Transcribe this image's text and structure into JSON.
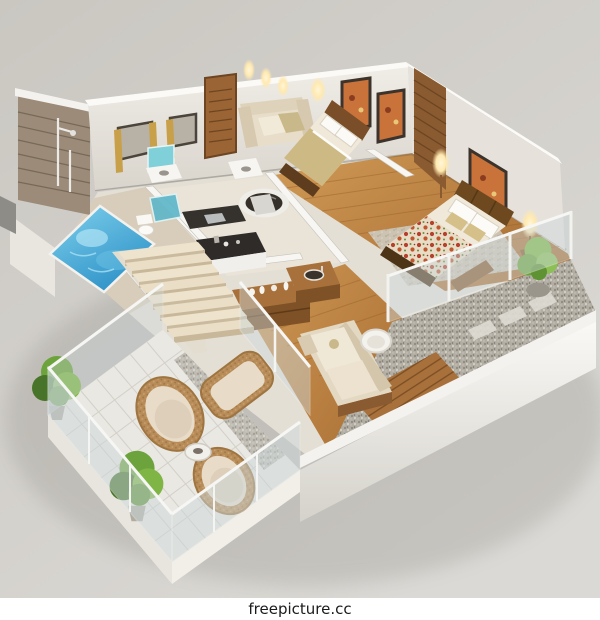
{
  "watermark": {
    "text": "freepicture.cc"
  },
  "colors": {
    "background_top": "#cac7c1",
    "background_bottom": "#dbd9d5",
    "watermark_bar": "#ffffff",
    "watermark_text": "#1b1b1b",
    "slab_white": "#f7f6f3",
    "slab_shade": "#d5d2cb",
    "wall_face": "#e6e2db",
    "wall_top": "#fbfaf7",
    "brick_wall": "#9c8b79",
    "pool_deep": "#2f93c8",
    "pool_light": "#7fd0ec",
    "pool_deck": "#d8cdbb",
    "tile_floor": "#e9e3d8",
    "wood_floor": "#c08544",
    "wood_dark": "#8a5a30",
    "door_wood": "#9a6434",
    "plant_green": "#6da33c",
    "plant_dark": "#48742a",
    "glass_tint": "#cdd9dc",
    "teal_glass": "#5fb7c9",
    "sofa_cream": "#e7ddc8",
    "wicker_tan": "#b88c58",
    "lamp_glow": "#ffe9b0",
    "gravel_gray": "#b2aea4",
    "rug_gray": "#cdc6b8",
    "floral_red": "#b5402e",
    "counter_dark": "#2f2b28",
    "curtain_gold": "#c9a04a"
  }
}
